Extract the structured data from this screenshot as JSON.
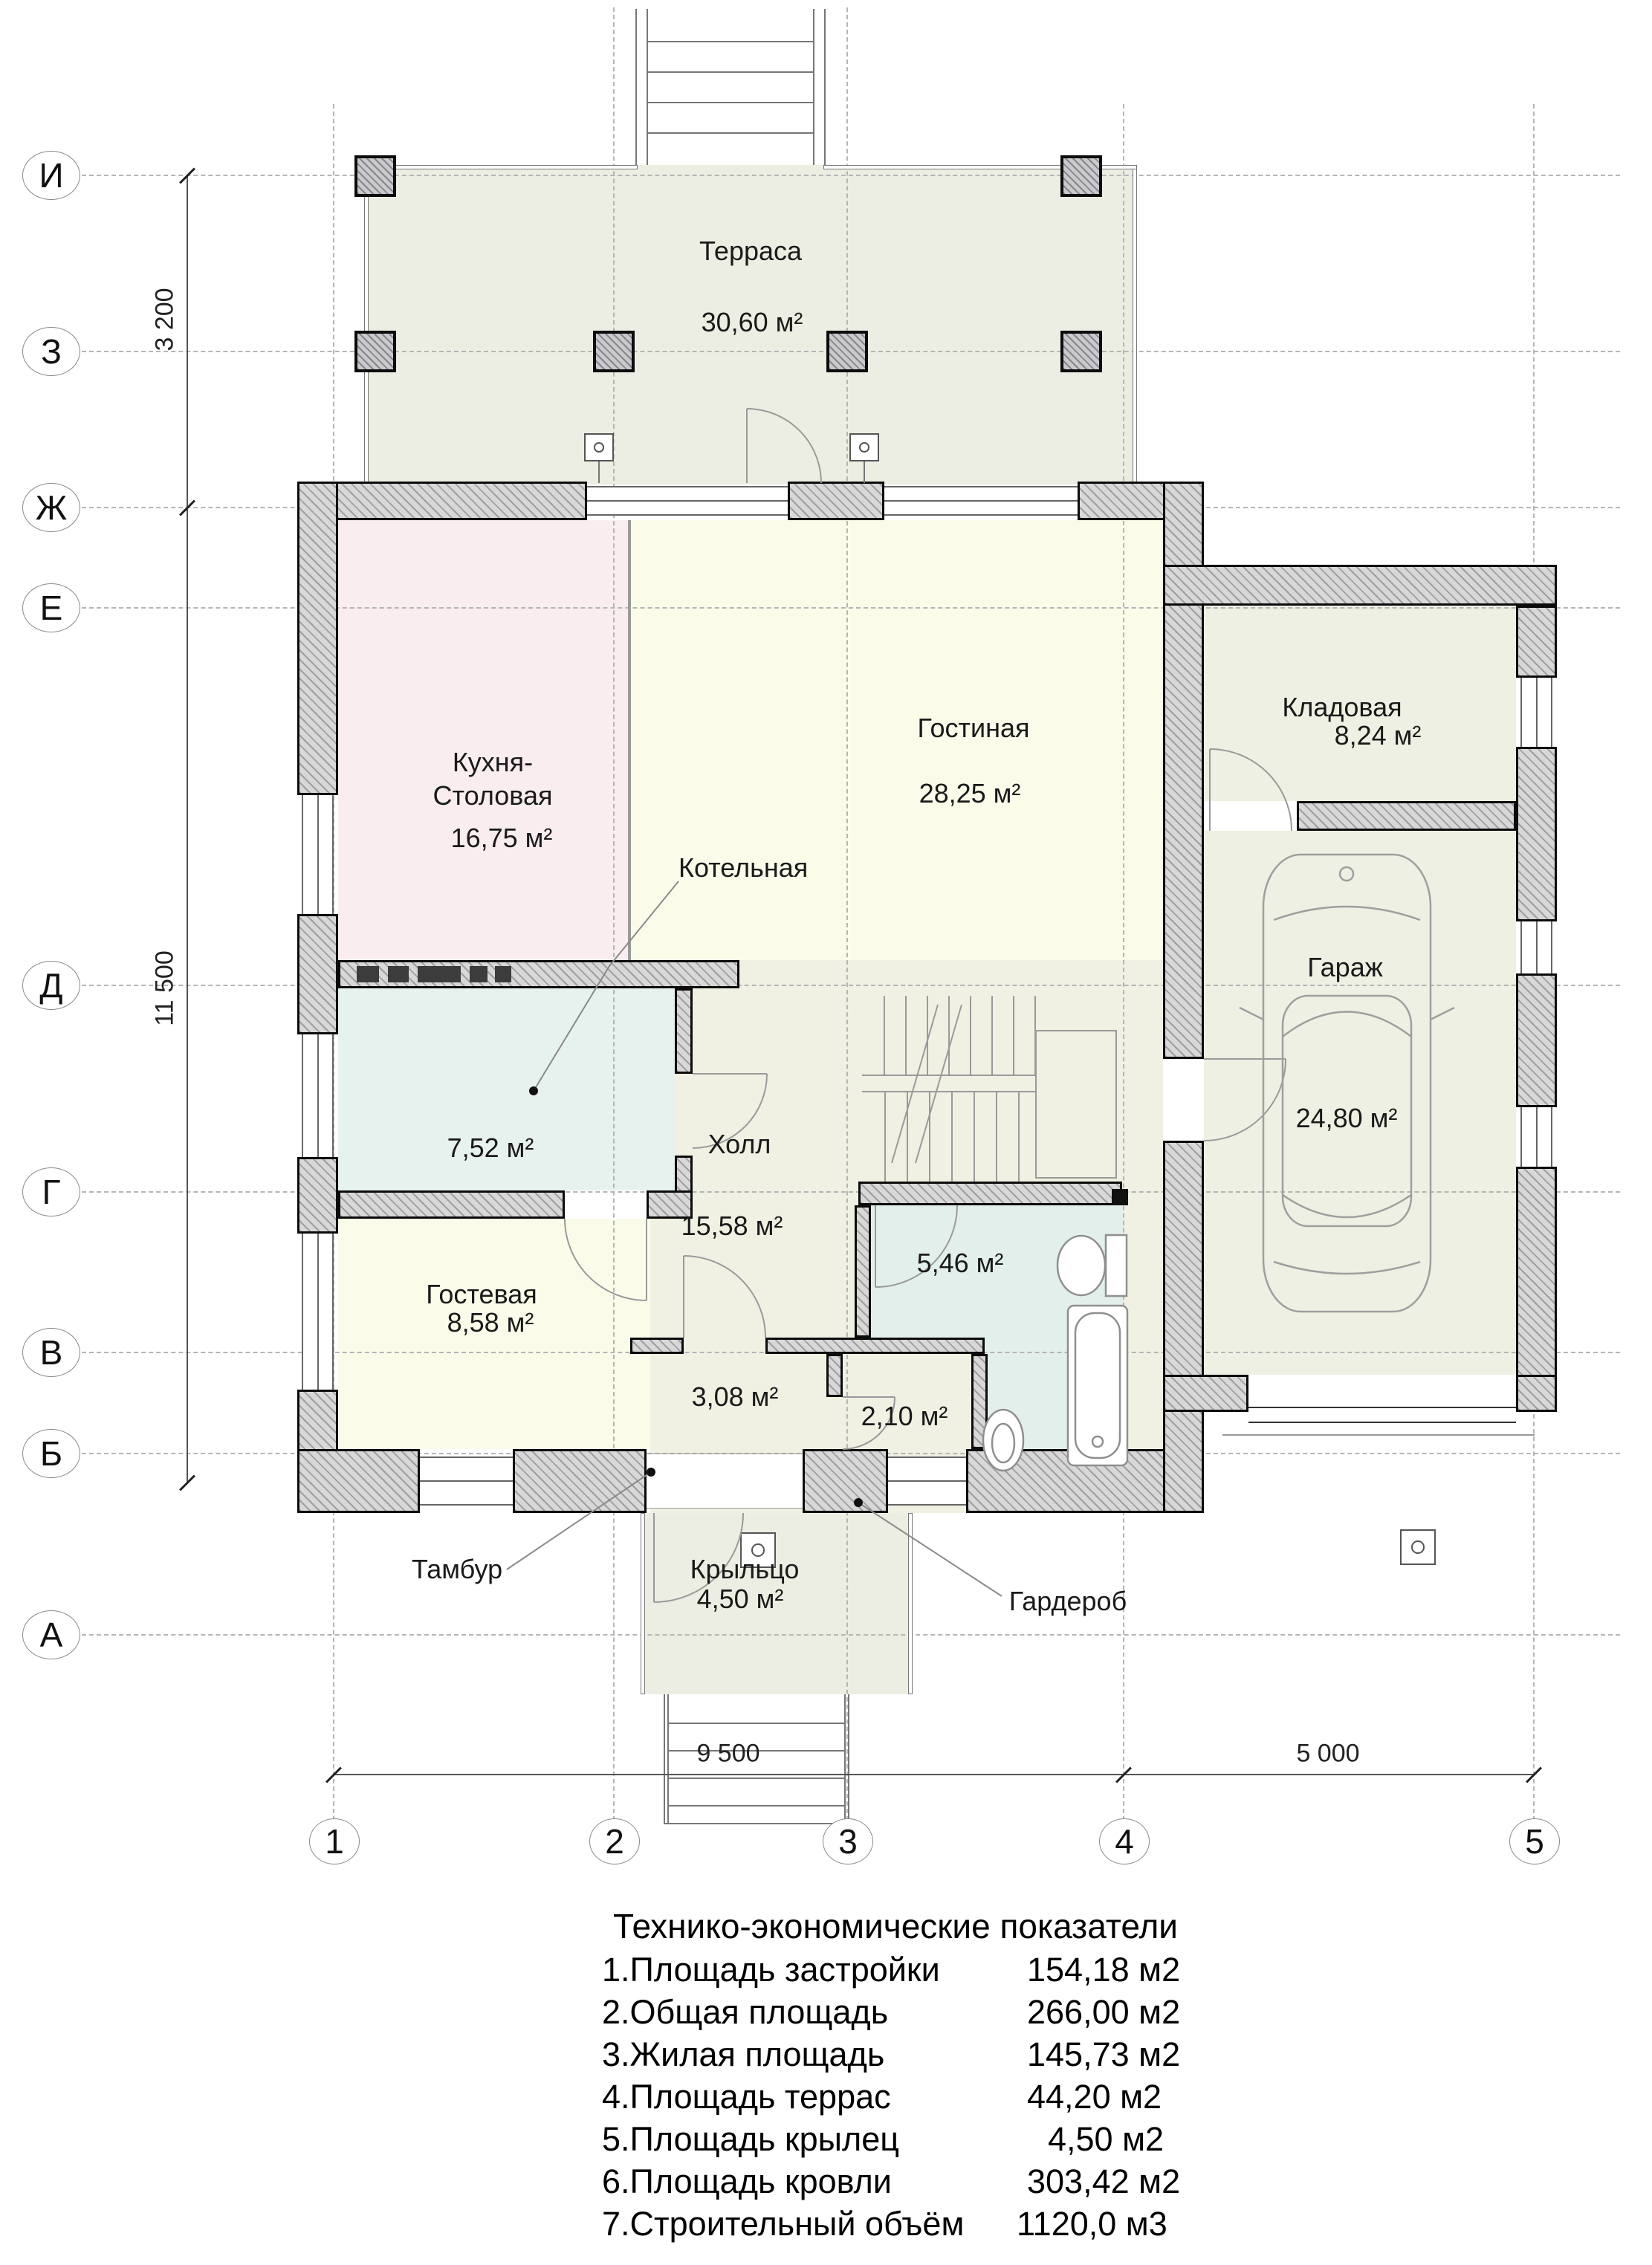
{
  "axes": {
    "rows": [
      {
        "label": "И"
      },
      {
        "label": "З"
      },
      {
        "label": "Ж"
      },
      {
        "label": "Е"
      },
      {
        "label": "Д"
      },
      {
        "label": "Г"
      },
      {
        "label": "В"
      },
      {
        "label": "Б"
      },
      {
        "label": "А"
      }
    ],
    "cols": [
      {
        "label": "1"
      },
      {
        "label": "2"
      },
      {
        "label": "3"
      },
      {
        "label": "4"
      },
      {
        "label": "5"
      }
    ]
  },
  "dimensions": {
    "terrace_depth": "3 200",
    "house_depth": "11 500",
    "main_width": "9 500",
    "garage_width": "5 000"
  },
  "rooms": {
    "terrace": {
      "name": "Терраса",
      "area": "30,60 м²"
    },
    "kitchen": {
      "name": "Кухня-Столовая",
      "area": "16,75 м²"
    },
    "living": {
      "name": "Гостиная",
      "area": "28,25 м²"
    },
    "pantry": {
      "name": "Кладовая",
      "area": "8,24 м²"
    },
    "garage": {
      "name": "Гараж",
      "area": "24,80 м²"
    },
    "boiler": {
      "name": "Котельная",
      "area": "7,52 м²"
    },
    "hall": {
      "name": "Холл",
      "area": "15,58 м²"
    },
    "guest": {
      "name": "Гостевая",
      "area": "8,58 м²"
    },
    "bathroom": {
      "area": "5,46 м²"
    },
    "tambour": {
      "name": "Тамбур",
      "area": "3,08 м²"
    },
    "wardrobe": {
      "name": "Гардероб",
      "area": "2,10 м²"
    },
    "porch": {
      "name": "Крыльцо",
      "area": "4,50 м²"
    }
  },
  "table": {
    "title": "Технико-экономические показатели",
    "rows": [
      {
        "label": "1.Площадь застройки",
        "value": "154,18 м2"
      },
      {
        "label": "2.Общая площадь",
        "value": "266,00 м2"
      },
      {
        "label": "3.Жилая площадь",
        "value": "145,73 м2"
      },
      {
        "label": "4.Площадь террас",
        "value": "44,20 м2"
      },
      {
        "label": "5.Площадь крылец",
        "value": "4,50 м2"
      },
      {
        "label": "6.Площадь кровли",
        "value": "303,42 м2"
      },
      {
        "label": "7.Строительный объём",
        "value": "1120,0 м3"
      }
    ]
  },
  "colors": {
    "terrace": "#edeee3",
    "kitchen": "#f9edef",
    "living": "#fafbe9",
    "pantry": "#edf0e2",
    "garage": "#edf0e2",
    "boiler": "#e7f1ed",
    "hall": "#f0f0e3",
    "guest": "#fafbe9",
    "bathroom": "#e3efeb",
    "walls": "#d8d8d8",
    "lines": "#0c0c0c"
  }
}
